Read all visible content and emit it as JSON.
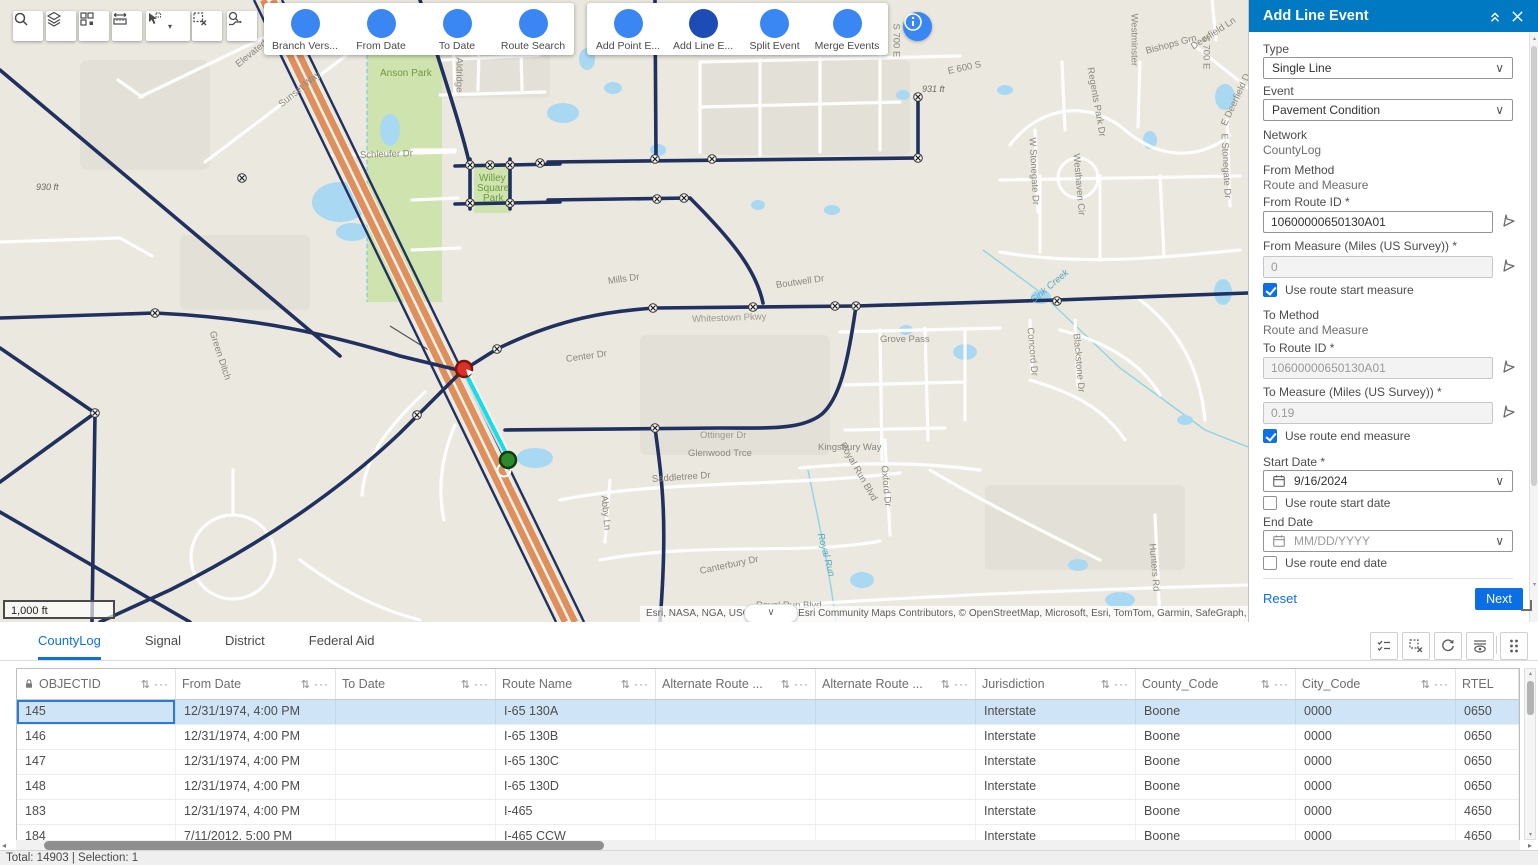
{
  "toolbar": {
    "map_tools": [
      {
        "name": "search",
        "icon": "search"
      },
      {
        "name": "layers",
        "icon": "layers"
      },
      {
        "name": "basemap-grid",
        "icon": "grid"
      },
      {
        "name": "measure",
        "icon": "measure"
      },
      {
        "name": "select",
        "icon": "select",
        "has_caret": true
      },
      {
        "name": "clear-selection",
        "icon": "clear-selection"
      },
      {
        "name": "route-select",
        "icon": "route-tool"
      }
    ],
    "event_groups": [
      {
        "items": [
          {
            "label": "Branch Vers...",
            "icon": "versions"
          },
          {
            "label": "From Date",
            "icon": "filter"
          },
          {
            "label": "To Date",
            "icon": "filter"
          },
          {
            "label": "Route Search",
            "icon": "route-search"
          }
        ]
      },
      {
        "items": [
          {
            "label": "Add Point E...",
            "icon": "add-point"
          },
          {
            "label": "Add Line E...",
            "icon": "add-line",
            "active": true
          },
          {
            "label": "Split Event",
            "icon": "split"
          },
          {
            "label": "Merge Events",
            "icon": "merge"
          }
        ]
      }
    ]
  },
  "map": {
    "scale_label": "1,000 ft",
    "attribution": "Esri, NASA, NGA, USGS, FEMA | Esri Community Maps Contributors, © OpenStreetMap, Microsoft, Esri, TomTom, Garmin, SafeGraph, GeoTechnol",
    "labels": [
      {
        "t": "Elevated Way",
        "x": 237,
        "y": 60,
        "r": -39
      },
      {
        "t": "Sunset Way",
        "x": 280,
        "y": 100,
        "r": -39
      },
      {
        "t": "Anson Park",
        "x": 380,
        "y": 68,
        "c": "park"
      },
      {
        "t": "Willey",
        "x": 479,
        "y": 173,
        "c": "park"
      },
      {
        "t": "Square",
        "x": 477,
        "y": 183,
        "c": "park"
      },
      {
        "t": "Park",
        "x": 483,
        "y": 193,
        "c": "park"
      },
      {
        "t": "Aldridge",
        "x": 459,
        "y": 52,
        "r": 90
      },
      {
        "t": "930 ft",
        "x": 36,
        "y": 182,
        "c": "elev"
      },
      {
        "t": "931 ft",
        "x": 922,
        "y": 84,
        "c": "elev"
      },
      {
        "t": "E 600 S",
        "x": 948,
        "y": 66,
        "r": -12
      },
      {
        "t": "S 700 E",
        "x": 896,
        "y": 18,
        "r": 90
      },
      {
        "t": "S 700 E",
        "x": 1206,
        "y": 30,
        "r": 90
      },
      {
        "t": "Westminster",
        "x": 1134,
        "y": 8,
        "r": 90
      },
      {
        "t": "Deerfield Ln",
        "x": 1192,
        "y": 42,
        "r": -33
      },
      {
        "t": "E Deerfield D",
        "x": 1224,
        "y": 120,
        "r": -65
      },
      {
        "t": "Regents Park Dr",
        "x": 1090,
        "y": 62,
        "r": 80
      },
      {
        "t": "Bishops Grn",
        "x": 1146,
        "y": 46,
        "r": -15
      },
      {
        "t": "Westhaven Cir",
        "x": 1076,
        "y": 148,
        "r": 85
      },
      {
        "t": "W Stonegate Dr",
        "x": 1032,
        "y": 132,
        "r": 87
      },
      {
        "t": "E Stonegate Dr",
        "x": 1224,
        "y": 128,
        "r": 87
      },
      {
        "t": "Schleufer Dr",
        "x": 360,
        "y": 150,
        "r": -2
      },
      {
        "t": "Mills Dr",
        "x": 608,
        "y": 276,
        "r": -8
      },
      {
        "t": "Boutwell Dr",
        "x": 776,
        "y": 280,
        "r": -8
      },
      {
        "t": "Whitestown Pkwy",
        "x": 692,
        "y": 314,
        "r": -2,
        "c": "road"
      },
      {
        "t": "Grove Pass",
        "x": 880,
        "y": 334
      },
      {
        "t": "Sink Creek",
        "x": 1032,
        "y": 296,
        "r": -40,
        "c": "water"
      },
      {
        "t": "Kingsbury Way",
        "x": 818,
        "y": 442
      },
      {
        "t": "Glenwood Trce",
        "x": 688,
        "y": 448
      },
      {
        "t": "Ottinger Dr",
        "x": 700,
        "y": 430,
        "c": "road"
      },
      {
        "t": "Saddletree Dr",
        "x": 652,
        "y": 474,
        "r": -4
      },
      {
        "t": "Abby Ln",
        "x": 604,
        "y": 490,
        "r": 85
      },
      {
        "t": "Canterbury Dr",
        "x": 700,
        "y": 566,
        "r": -12
      },
      {
        "t": "Royal Run Blvd",
        "x": 756,
        "y": 600
      },
      {
        "t": "Royal Run Blvd",
        "x": 842,
        "y": 438,
        "r": 60
      },
      {
        "t": "Royal Run",
        "x": 820,
        "y": 528,
        "r": 75,
        "c": "water"
      },
      {
        "t": "Oxford Dr",
        "x": 884,
        "y": 460,
        "r": 85
      },
      {
        "t": "Hunters Rd",
        "x": 1152,
        "y": 538,
        "r": 85
      },
      {
        "t": "Concord Dr",
        "x": 1030,
        "y": 322,
        "r": 85
      },
      {
        "t": "Blackstone Dr",
        "x": 1076,
        "y": 328,
        "r": 85
      },
      {
        "t": "Center Dr",
        "x": 566,
        "y": 354,
        "r": -8
      },
      {
        "t": "Green Ditch",
        "x": 212,
        "y": 326,
        "r": 72
      }
    ]
  },
  "panel": {
    "title": "Add Line Event",
    "type_label": "Type",
    "type_value": "Single Line",
    "event_label": "Event",
    "event_value": "Pavement Condition",
    "network_label": "Network",
    "network_value": "CountyLog",
    "from_method_label": "From Method",
    "from_method_value": "Route and Measure",
    "from_route_label": "From Route ID *",
    "from_route_value": "10600000650130A01",
    "from_measure_label": "From Measure (Miles (US Survey)) *",
    "from_measure_value": "0",
    "use_route_start_measure_label": "Use route start measure",
    "use_route_start_measure_checked": true,
    "to_method_label": "To Method",
    "to_method_value": "Route and Measure",
    "to_route_label": "To Route ID *",
    "to_route_value": "10600000650130A01",
    "to_measure_label": "To Measure (Miles (US Survey)) *",
    "to_measure_value": "0.19",
    "use_route_end_measure_label": "Use route end measure",
    "use_route_end_measure_checked": true,
    "start_date_label": "Start Date *",
    "start_date_value": "9/16/2024",
    "use_route_start_date_label": "Use route start date",
    "use_route_start_date_checked": false,
    "end_date_label": "End Date",
    "end_date_placeholder": "MM/DD/YYYY",
    "use_route_end_date_label": "Use route end date",
    "use_route_end_date_checked": false,
    "reset_label": "Reset",
    "next_label": "Next"
  },
  "table": {
    "tabs": [
      {
        "label": "CountyLog",
        "active": true
      },
      {
        "label": "Signal"
      },
      {
        "label": "District"
      },
      {
        "label": "Federal Aid"
      }
    ],
    "columns": [
      {
        "label": "OBJECTID",
        "locked": true
      },
      {
        "label": "From Date"
      },
      {
        "label": "To Date"
      },
      {
        "label": "Route Name"
      },
      {
        "label": "Alternate Route ..."
      },
      {
        "label": "Alternate Route ..."
      },
      {
        "label": "Jurisdiction"
      },
      {
        "label": "County_Code"
      },
      {
        "label": "City_Code"
      },
      {
        "label": "RTEL"
      }
    ],
    "rows": [
      [
        "145",
        "12/31/1974, 4:00 PM",
        "",
        "I-65 130A",
        "",
        "",
        "Interstate",
        "Boone",
        "0000",
        "0650"
      ],
      [
        "146",
        "12/31/1974, 4:00 PM",
        "",
        "I-65 130B",
        "",
        "",
        "Interstate",
        "Boone",
        "0000",
        "0650"
      ],
      [
        "147",
        "12/31/1974, 4:00 PM",
        "",
        "I-65 130C",
        "",
        "",
        "Interstate",
        "Boone",
        "0000",
        "0650"
      ],
      [
        "148",
        "12/31/1974, 4:00 PM",
        "",
        "I-65 130D",
        "",
        "",
        "Interstate",
        "Boone",
        "0000",
        "0650"
      ],
      [
        "183",
        "12/31/1974, 4:00 PM",
        "",
        "I-465",
        "",
        "",
        "Interstate",
        "Boone",
        "0000",
        "4650"
      ],
      [
        "184",
        "7/11/2012, 5:00 PM",
        "",
        "I-465 CCW",
        "",
        "",
        "Interstate",
        "Boone",
        "0000",
        "4650"
      ]
    ],
    "selected_row_index": 0,
    "status": "Total: 14903 | Selection: 1"
  },
  "colors": {
    "accent": "#0079c2",
    "tool_blue": "#3a86f2",
    "tool_blue_active": "#1d4db4",
    "next_button": "#0b6ee4",
    "selected_row": "#cfe4f6",
    "tab_active": "#0b72d9",
    "highway_orange": "#df8f5c",
    "road_navy": "#21315f",
    "selection_cyan": "#12dfe6"
  }
}
